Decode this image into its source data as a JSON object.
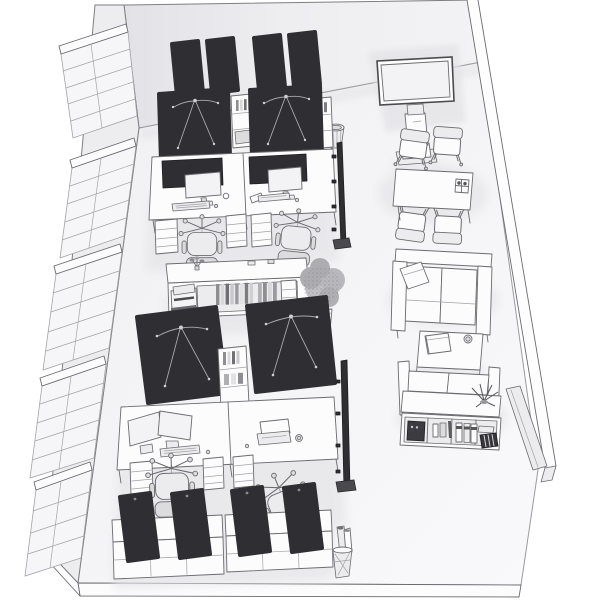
{
  "title": "Isometric 3D office room render (monochrome)",
  "canvas": {
    "width": 600,
    "height": 600
  },
  "colors": {
    "bg": "#ffffff",
    "floor_a": "#f0f0f3",
    "floor_b": "#f9f9fb",
    "wall_back_a": "#e2e2e7",
    "wall_back_b": "#f1f1f4",
    "wall_left": "#ededf0",
    "wall_glass": "#f6f6f8",
    "white": "#fcfcfd",
    "lite": "#ececef",
    "mid": "#dcdcdf",
    "dark": "#2e2e33",
    "dark_edge": "#1e1e22",
    "line": "#6b6b70",
    "line_soft": "#a3a3a8",
    "cable": "#a8a8ac",
    "cable_dot": "#cfcfd3",
    "shadow": "#e4e4e8",
    "foliage_a": "#c2c2c6",
    "foliage_b": "#aeaeb2",
    "screen": "#f3f3f5"
  },
  "room": {
    "type": "open-plan office, isometric bird's-eye view",
    "left_wall": {
      "kind": "glazed window wall",
      "window_modules": 5
    },
    "back_wall": {
      "kind": "solid wall"
    },
    "right_wall": {
      "kind": "thin side wall seen edge-on, ends mid-room"
    },
    "front": {
      "kind": "open (cutaway) with floor slab edge"
    }
  },
  "furniture": [
    {
      "name": "workstation-cluster-north",
      "workstations": 4,
      "dark_canopy_desks": 2,
      "monitor_desks": 2,
      "task_chairs": 2,
      "high_back_panels": 4,
      "drawer_pedestals": 3,
      "spine_shelves": 2
    },
    {
      "name": "workstation-cluster-south",
      "workstations": 4,
      "dark_canopy_desks": 2,
      "monitor_desks": 2,
      "task_chairs": 2,
      "monitors_dual": 2,
      "laptop": 1,
      "drawer_pedestals": 3,
      "spine_shelves": 1
    },
    {
      "name": "credenza-sideboard",
      "contents": "binders, books, small cabinet, desktop printer, plant sprig"
    },
    {
      "name": "potted-plant-large",
      "qty": 1
    },
    {
      "name": "tv-display-floor-stand",
      "qty": 1
    },
    {
      "name": "meeting-table",
      "chairs": 4,
      "tabletop_item": "cup caddy with 2 cups"
    },
    {
      "name": "waste-basket-round",
      "qty": 1
    },
    {
      "name": "sofa-two-seater-north",
      "pillow": 1
    },
    {
      "name": "coffee-table",
      "items": "notebook, cup"
    },
    {
      "name": "sofa-two-seater-south",
      "back_shelf_plant": 1
    },
    {
      "name": "open-shelf-unit",
      "contents": "appliance, jars, 3 ring binders, paper stack, striped file box"
    },
    {
      "name": "partition-panel",
      "qty": 1
    },
    {
      "name": "low-sideboards-south",
      "qty": 2,
      "leaning_acoustic_panels": 4
    },
    {
      "name": "waste-basket-with-paper-rolls",
      "qty": 1
    },
    {
      "name": "mobile-board-edge-on",
      "qty": 2
    }
  ]
}
